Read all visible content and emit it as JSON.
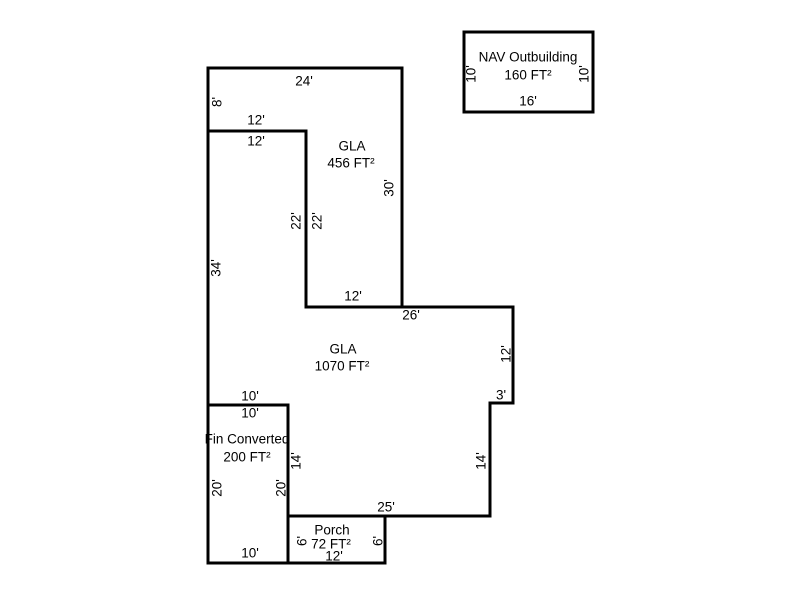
{
  "canvas": {
    "width": 800,
    "height": 600,
    "background": "#ffffff",
    "wall_color": "#000000",
    "wall_width": 3,
    "text_color": "#000000",
    "font_size": 13.5
  },
  "shapes": [
    {
      "id": "gla-upper",
      "points": [
        [
          208,
          68
        ],
        [
          402,
          68
        ],
        [
          402,
          307
        ],
        [
          306,
          307
        ],
        [
          306,
          131
        ],
        [
          208,
          131
        ]
      ],
      "labels": [
        {
          "text": "GLA",
          "x": 352,
          "y": 146
        },
        {
          "text": "456 FT²",
          "x": 351,
          "y": 163
        }
      ]
    },
    {
      "id": "gla-main",
      "points": [
        [
          208,
          131
        ],
        [
          306,
          131
        ],
        [
          306,
          307
        ],
        [
          513,
          307
        ],
        [
          513,
          403
        ],
        [
          490,
          403
        ],
        [
          490,
          516
        ],
        [
          288,
          516
        ],
        [
          288,
          405
        ],
        [
          208,
          405
        ]
      ],
      "labels": [
        {
          "text": "GLA",
          "x": 343,
          "y": 349
        },
        {
          "text": "1070 FT²",
          "x": 342,
          "y": 366
        }
      ]
    },
    {
      "id": "fin-converted",
      "points": [
        [
          208,
          405
        ],
        [
          288,
          405
        ],
        [
          288,
          563
        ],
        [
          208,
          563
        ]
      ],
      "labels": [
        {
          "text": "Fin Converted",
          "x": 247,
          "y": 439
        },
        {
          "text": "200 FT²",
          "x": 247,
          "y": 457
        }
      ]
    },
    {
      "id": "porch",
      "points": [
        [
          288,
          516
        ],
        [
          385,
          516
        ],
        [
          385,
          563
        ],
        [
          288,
          563
        ]
      ],
      "labels": [
        {
          "text": "Porch",
          "x": 332,
          "y": 530
        },
        {
          "text": "72 FT²",
          "x": 331,
          "y": 544
        }
      ]
    },
    {
      "id": "outbuilding",
      "points": [
        [
          464,
          32
        ],
        [
          593,
          32
        ],
        [
          593,
          112
        ],
        [
          464,
          112
        ]
      ],
      "labels": [
        {
          "text": "NAV Outbuilding",
          "x": 528,
          "y": 57
        },
        {
          "text": "160 FT²",
          "x": 528,
          "y": 75
        }
      ]
    }
  ],
  "dimensions": [
    {
      "text": "24'",
      "x": 304,
      "y": 81,
      "rotate": 0
    },
    {
      "text": "8'",
      "x": 217,
      "y": 102,
      "rotate": -90
    },
    {
      "text": "12'",
      "x": 256,
      "y": 120,
      "rotate": 0
    },
    {
      "text": "12'",
      "x": 256,
      "y": 141,
      "rotate": 0
    },
    {
      "text": "22'",
      "x": 296,
      "y": 221,
      "rotate": -90
    },
    {
      "text": "22'",
      "x": 317,
      "y": 221,
      "rotate": -90
    },
    {
      "text": "30'",
      "x": 389,
      "y": 188,
      "rotate": -90
    },
    {
      "text": "12'",
      "x": 353,
      "y": 296,
      "rotate": 0
    },
    {
      "text": "26'",
      "x": 411,
      "y": 315,
      "rotate": 0
    },
    {
      "text": "34'",
      "x": 216,
      "y": 268,
      "rotate": -90
    },
    {
      "text": "12'",
      "x": 506,
      "y": 354,
      "rotate": -90
    },
    {
      "text": "3'",
      "x": 501,
      "y": 395,
      "rotate": 0
    },
    {
      "text": "14'",
      "x": 481,
      "y": 461,
      "rotate": -90
    },
    {
      "text": "25'",
      "x": 386,
      "y": 507,
      "rotate": 0
    },
    {
      "text": "10'",
      "x": 250,
      "y": 396,
      "rotate": 0
    },
    {
      "text": "10'",
      "x": 250,
      "y": 413,
      "rotate": 0
    },
    {
      "text": "14'",
      "x": 296,
      "y": 461,
      "rotate": -90
    },
    {
      "text": "20'",
      "x": 217,
      "y": 488,
      "rotate": -90
    },
    {
      "text": "20'",
      "x": 281,
      "y": 488,
      "rotate": -90
    },
    {
      "text": "10'",
      "x": 250,
      "y": 553,
      "rotate": 0
    },
    {
      "text": "6'",
      "x": 302,
      "y": 541,
      "rotate": -90
    },
    {
      "text": "6'",
      "x": 378,
      "y": 541,
      "rotate": -90
    },
    {
      "text": "12'",
      "x": 334,
      "y": 556,
      "rotate": 0
    },
    {
      "text": "10'",
      "x": 471,
      "y": 74,
      "rotate": -90
    },
    {
      "text": "10'",
      "x": 584,
      "y": 74,
      "rotate": -90
    },
    {
      "text": "16'",
      "x": 528,
      "y": 101,
      "rotate": 0
    }
  ]
}
